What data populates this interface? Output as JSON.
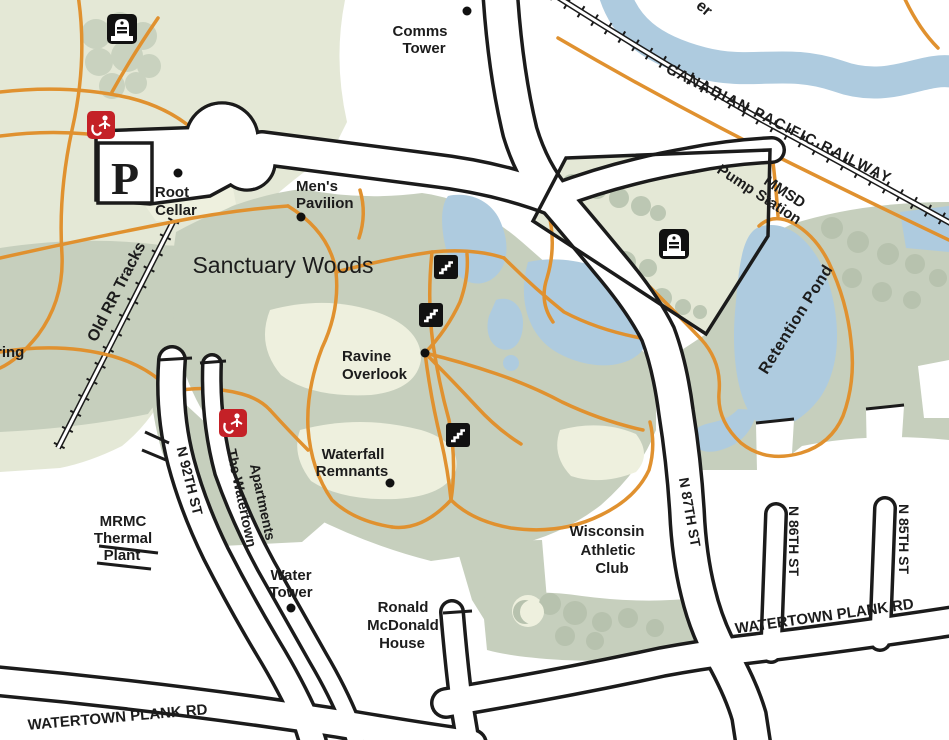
{
  "map": {
    "title": "Sanctuary Woods park trail map",
    "colors": {
      "background": "#ffffff",
      "park_light_green": "#e4e8d6",
      "woods_sage": "#c6cfbd",
      "tree_blob": "#b7c2ae",
      "clearing_cream": "#eef0de",
      "water_blue": "#aecbdf",
      "trail_orange": "#e0912f",
      "road_casing_black": "#1b1b1b",
      "icon_red": "#c42127",
      "icon_black": "#111111"
    },
    "icons": [
      "parking-p-icon",
      "monument-icon",
      "litter-disposal-icon",
      "stairs-icon",
      "poi-dot"
    ]
  },
  "labels": {
    "comms_tower_1": "Comms",
    "comms_tower_2": "Tower",
    "root_cellar_1": "Root",
    "root_cellar_2": "Cellar",
    "mens_pavilion_1": "Men's",
    "mens_pavilion_2": "Pavilion",
    "sanctuary_woods": "Sanctuary Woods",
    "ravine_overlook_1": "Ravine",
    "ravine_overlook_2": "Overlook",
    "waterfall_remnants_1": "Waterfall",
    "waterfall_remnants_2": "Remnants",
    "water_tower_1": "Water",
    "water_tower_2": "Tower",
    "ronald_mcdonald_1": "Ronald",
    "ronald_mcdonald_2": "McDonald",
    "ronald_mcdonald_3": "House",
    "wisconsin_athletic_1": "Wisconsin",
    "wisconsin_athletic_2": "Athletic",
    "wisconsin_athletic_3": "Club",
    "mrmc_1": "MRMC",
    "mrmc_2": "Thermal",
    "mrmc_3": "Plant",
    "watertown_apts_1": "The Watertown",
    "watertown_apts_2": "Apartments",
    "mmsd_1": "MMSD",
    "mmsd_2": "Pump Station",
    "cp_railway": "CANADIAN PACIFIC RAILWAY",
    "old_rr_tracks": "Old RR Tracks",
    "retention_pond": "Retention Pond",
    "n_92th_st": "N 92TH ST",
    "n_87th_st": "N 87TH ST",
    "n_86th_st": "N 86TH ST",
    "n_85th_st": "N 85TH ST",
    "watertown_plank_left": "WATERTOWN PLANK RD",
    "watertown_plank_right": "WATERTOWN PLANK RD",
    "parking_p": "P",
    "river_partial": "er",
    "spring_partial": "ring"
  }
}
